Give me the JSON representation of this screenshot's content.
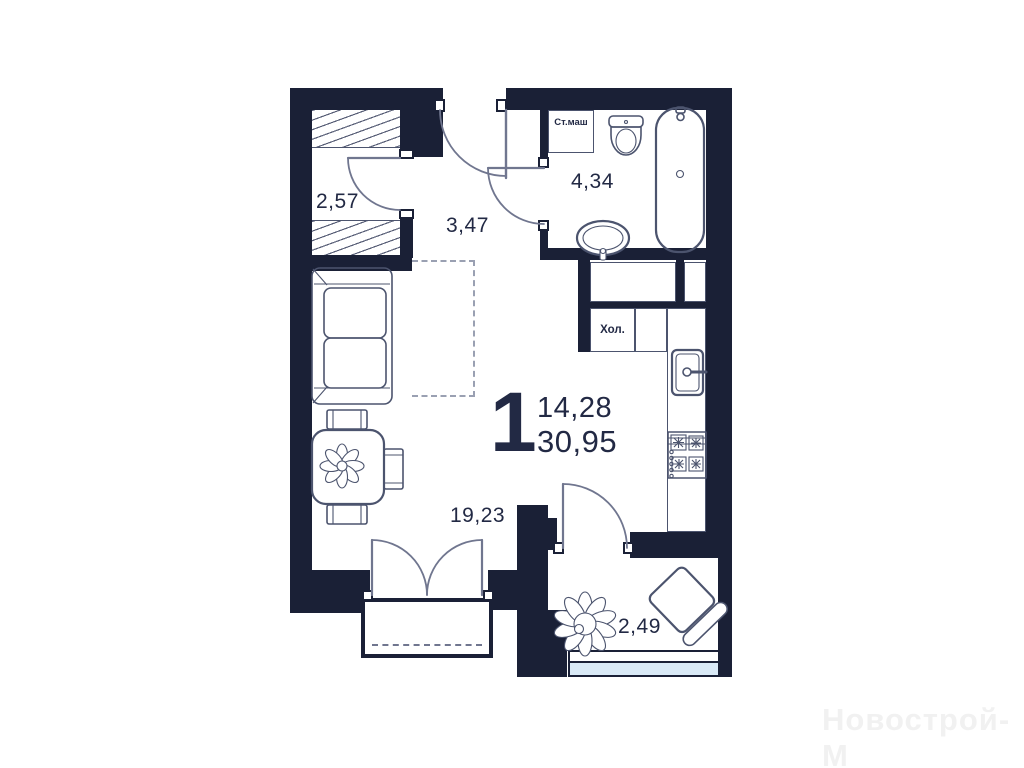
{
  "plan": {
    "type_label": "1",
    "living_area": "14,28",
    "total_area": "30,95",
    "rooms": {
      "wardrobe": {
        "area": "2,57"
      },
      "hallway": {
        "area": "3,47"
      },
      "bathroom": {
        "area": "4,34"
      },
      "living_room": {
        "area": "19,23"
      },
      "balcony": {
        "area": "2,49"
      }
    },
    "appliances": {
      "washing_machine": "Ст.маш",
      "fridge": "Хол."
    }
  },
  "watermark": "Новострой-М",
  "colors": {
    "wall": "#1a2036",
    "furniture_line": "#4c546e",
    "door_line": "#70768f",
    "glazing": "#d9e9f6",
    "text": "#222944",
    "watermark": "#f1f1f1"
  }
}
